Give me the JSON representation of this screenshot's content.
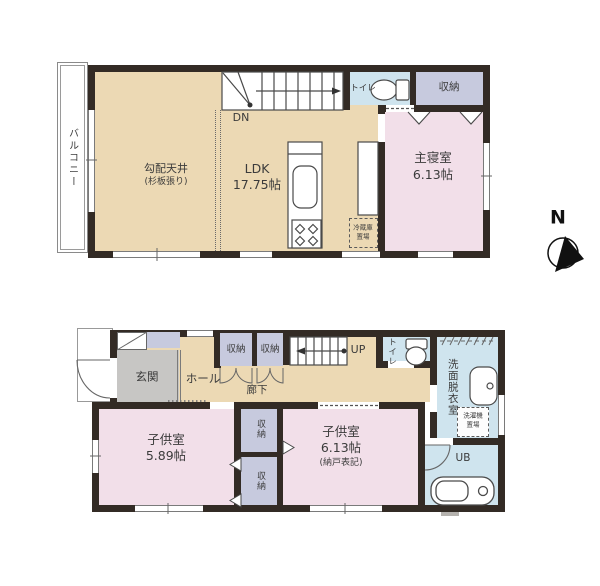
{
  "compass": {
    "north_label": "N"
  },
  "floor2": {
    "balcony_label": "バルコニー",
    "sloped_ceiling_label": "勾配天井",
    "sloped_ceiling_note": "(杉板張り)",
    "ldk_label": "LDK",
    "ldk_size": "17.75帖",
    "stairs_down_label": "DN",
    "toilet_label": "トイレ",
    "closet_label": "収納",
    "master_bedroom_label": "主寝室",
    "master_bedroom_size": "6.13帖",
    "fridge_label_1": "冷蔵庫",
    "fridge_label_2": "置場"
  },
  "floor1": {
    "entrance_label": "玄関",
    "hall_label": "ホール",
    "corridor_label": "廊下",
    "hall_closet_left_label": "収納",
    "hall_closet_right_label": "収納",
    "stairs_up_label": "UP",
    "toilet_label": "トイレ",
    "washroom_label": "洗面脱衣室",
    "washer_label_1": "洗濯機",
    "washer_label_2": "置場",
    "bath_label": "UB",
    "child_room1_label": "子供室",
    "child_room1_size": "5.89帖",
    "child_room2_label": "子供室",
    "child_room2_size": "6.13帖",
    "child_room2_note": "(納戸表記)",
    "mid_closet_upper_label": "収納",
    "mid_closet_lower_label": "収納"
  },
  "colors": {
    "wall": "#332b25",
    "wood_floor": "#ecd9b4",
    "bedroom_pink": "#f2dfe9",
    "closet_lavender": "#c7cade",
    "wet_area_blue": "#cfe4ee",
    "entrance_gray": "#c7c6c4"
  }
}
